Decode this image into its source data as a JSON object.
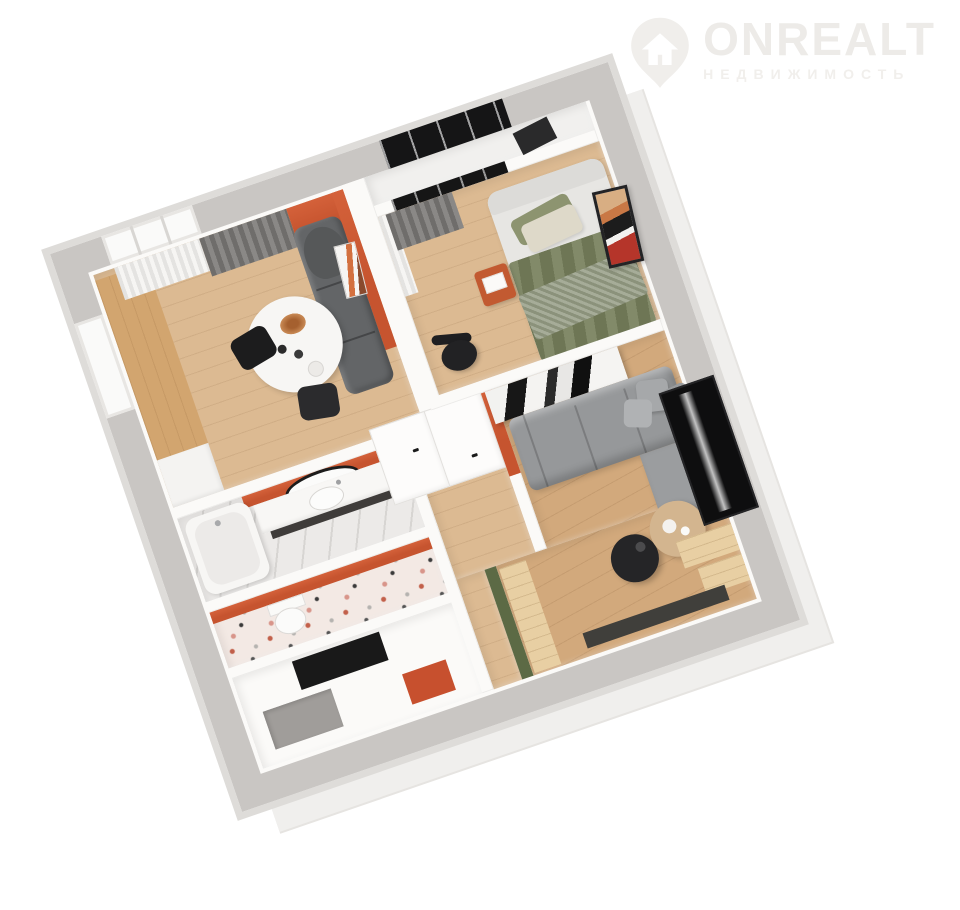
{
  "watermark": {
    "brand": "ONREALT",
    "subtitle": "НЕДВИЖИМОСТЬ",
    "icon": "house-location-pin-icon",
    "color": "#edebe8"
  },
  "scene": {
    "type": "3d-floor-plan-render",
    "view": "top-down isometric, rotated",
    "rotation_deg": -19,
    "background": "#ffffff",
    "colors": {
      "wallTop": "#c9c6c3",
      "wallRim": "#dedcd9",
      "wallFace": "#fbfaf8",
      "wood": "#dcba92",
      "woodWarm": "#d2a97c",
      "counter": "#d2a56f",
      "benchWood": "#e8cfa3",
      "orange": "#c6542f",
      "green": "#5c6a45",
      "charcoal": "#1c1c1d",
      "sofaDark": "#636567",
      "sofaGray": "#96989a",
      "curtain": "#7b7977",
      "marble": "#eceae8",
      "marbleGray": "#b3b0ad",
      "terrazzo": "#f3e9e4",
      "bedOlive": "#77805c",
      "throw": "#9aa18a",
      "bedFrame": "#e7e6e3",
      "tan": "#d3b58f",
      "dark": "#141414",
      "balconyFloor": "#f1f0ee",
      "logo": "#edebe8"
    }
  },
  "rooms": [
    {
      "id": "kitchen-dining",
      "floor": "light-wood",
      "features": [
        "window with sheer curtain",
        "gray drape",
        "orange accent wall",
        "wood kitchen counter",
        "white base cabinets",
        "charcoal sofa",
        "round white dining table with dried-flower decor",
        "two black chairs",
        "leaning orange artwork"
      ]
    },
    {
      "id": "balcony",
      "floor": "white",
      "features": [
        "black-framed glazing",
        "dark easel"
      ]
    },
    {
      "id": "bedroom",
      "floor": "light-wood",
      "features": [
        "gray curtain",
        "sheer curtain",
        "upholstered bed with olive blanket and knit throw",
        "white and olive pillows",
        "orange nightstand with white book",
        "black desk chair",
        "abstract red-black wall art"
      ]
    },
    {
      "id": "living-room",
      "floor": "warm-wood",
      "features": [
        "black-and-white abstract wardrobe panel",
        "gray corner sofa with cushions",
        "black round coffee table",
        "tan round coffee table",
        "wall-mounted TV in niche",
        "orange accent wall",
        "olive-green accent wall",
        "pale wood bench steps",
        "dark sideboard"
      ]
    },
    {
      "id": "bathroom",
      "floor": "white-marble",
      "features": [
        "bathtub",
        "white vanity with sink",
        "oval black-framed mirror",
        "orange accent wall"
      ]
    },
    {
      "id": "wc",
      "floor": "terrazzo",
      "features": [
        "toilet",
        "orange accent wall"
      ]
    },
    {
      "id": "entry-hall",
      "floor": "gray-marble-tile",
      "features": [
        "black doormat",
        "gray mat",
        "orange mat"
      ]
    },
    {
      "id": "corridor",
      "floor": "light-wood",
      "features": [
        "white double doors with black handles",
        "green wall strip"
      ]
    }
  ]
}
